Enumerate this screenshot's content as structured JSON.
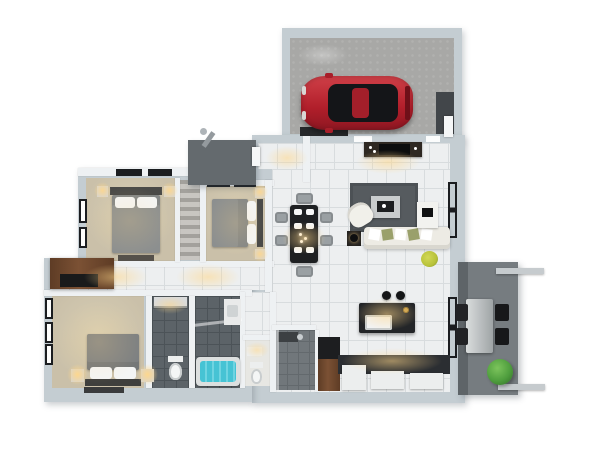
{
  "canvas": {
    "width": 600,
    "height": 454,
    "background": "#ffffff",
    "description": "3D aerial render of a 3-bedroom house floor plan with attached garage and patio"
  },
  "colors": {
    "wall": "#c4cdd2",
    "wall_inner": "#eef1f3",
    "tile": "#edeff0",
    "grout": "#d8dcde",
    "bedroom_floor": "#cac0a9",
    "garage_floor": "#a8a8a6",
    "porch": "#646a6e",
    "patio": "#767c80",
    "patio_shadow": "#5e6468",
    "bath_tile": "#5c6368",
    "bath_grout": "#4c5358",
    "shower_tile": "#71777b",
    "wc_floor": "#e7e7e3",
    "car_red": "#c02430",
    "car_dark": "#141518",
    "car_roof": "#a31f2a",
    "duvet": "#8c8f8f",
    "duvet_master": "#7d8082",
    "pillow": "#f4f5f5",
    "headboard": "#4a4a48",
    "wood": "#7b5134",
    "wood_dark": "#5e3c25",
    "tub_water": "#46c3d4",
    "tub_rim": "#dcdfdf",
    "sofa": "#edebe4",
    "pillow_olive": "#9aa06b",
    "rug": "#565b5f",
    "table_black": "#1e2022",
    "island_black": "#232528",
    "counter_dark": "#2b2e32",
    "chair_gray": "#9aa0a3",
    "appliance": "#eceeee",
    "plant_green": "#4f9e3e",
    "plant_yellow": "#b8c23a",
    "lamp_glow": "#ffd78a",
    "window_frame": "#1b1d20",
    "railing": "#c6cbce",
    "furniture_light": "#d5d8d9"
  },
  "rooms": [
    {
      "id": "garage",
      "floor": "garage_floor",
      "contents": [
        "red-sports-car",
        "workbench",
        "side-door"
      ]
    },
    {
      "id": "entry-porch",
      "floor": "porch",
      "contents": [
        "porch-lamp",
        "front-door"
      ]
    },
    {
      "id": "foyer",
      "floor": "tile",
      "contents": []
    },
    {
      "id": "living-room",
      "floor": "tile",
      "contents": [
        "tv-console",
        "rug",
        "coffee-table",
        "armchair",
        "sofa",
        "side-table",
        "desk",
        "yellow-plant"
      ]
    },
    {
      "id": "dining-area",
      "floor": "tile",
      "contents": [
        "dining-table",
        "six-chairs",
        "place-settings",
        "pendant-lights"
      ]
    },
    {
      "id": "kitchen",
      "floor": "tile",
      "contents": [
        "island-with-sink",
        "pendant-lamps",
        "counter",
        "fridge",
        "appliances"
      ]
    },
    {
      "id": "bedroom-1",
      "floor": "bedroom_floor",
      "contents": [
        "double-bed",
        "nightstands",
        "lamps",
        "foot-bench",
        "windows"
      ]
    },
    {
      "id": "closet",
      "floor": "closet",
      "contents": [
        "shelving"
      ]
    },
    {
      "id": "bedroom-2",
      "floor": "bedroom_floor",
      "contents": [
        "double-bed",
        "nightstands",
        "lamps"
      ]
    },
    {
      "id": "hallway",
      "floor": "tile",
      "contents": [
        "walnut-wardrobe"
      ]
    },
    {
      "id": "master-bedroom",
      "floor": "bedroom_floor",
      "contents": [
        "king-bed",
        "nightstands",
        "lamps",
        "rug",
        "windows"
      ]
    },
    {
      "id": "bathroom-1",
      "floor": "bath_tile",
      "contents": [
        "vanity",
        "toilet"
      ]
    },
    {
      "id": "bathroom-2",
      "floor": "bath_tile",
      "contents": [
        "vanity",
        "bathtub-teal",
        "glass-partition"
      ]
    },
    {
      "id": "wc",
      "floor": "wc_floor",
      "contents": [
        "basin",
        "toilet"
      ]
    },
    {
      "id": "shower-room",
      "floor": "shower_tile",
      "contents": [
        "shower-fixture",
        "glass-wall"
      ]
    },
    {
      "id": "pantry-door",
      "floor": "wood",
      "contents": [
        "wood-door"
      ]
    },
    {
      "id": "patio",
      "floor": "patio",
      "contents": [
        "outdoor-table",
        "four-chairs",
        "green-plant",
        "railing"
      ]
    }
  ]
}
